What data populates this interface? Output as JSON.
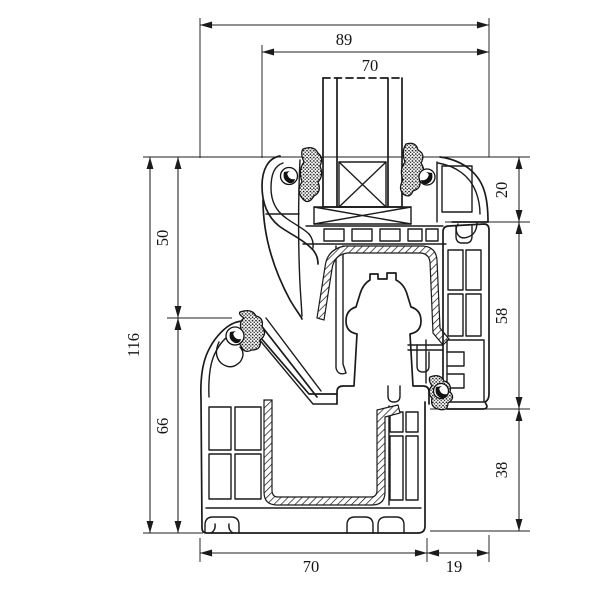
{
  "drawing": {
    "type": "technical-cross-section",
    "subject": "PVC window frame and sash profile section with glazing unit",
    "units": "mm",
    "colors": {
      "line": "#1b1b1b",
      "background": "#ffffff"
    },
    "dimensions": {
      "top_overall": "89",
      "top_glazing": "70",
      "left_total": "116",
      "left_upper": "50",
      "left_lower": "66",
      "right_upper": "20",
      "right_middle": "58",
      "right_lower": "38",
      "bottom_frame": "70",
      "bottom_extension": "19"
    }
  }
}
